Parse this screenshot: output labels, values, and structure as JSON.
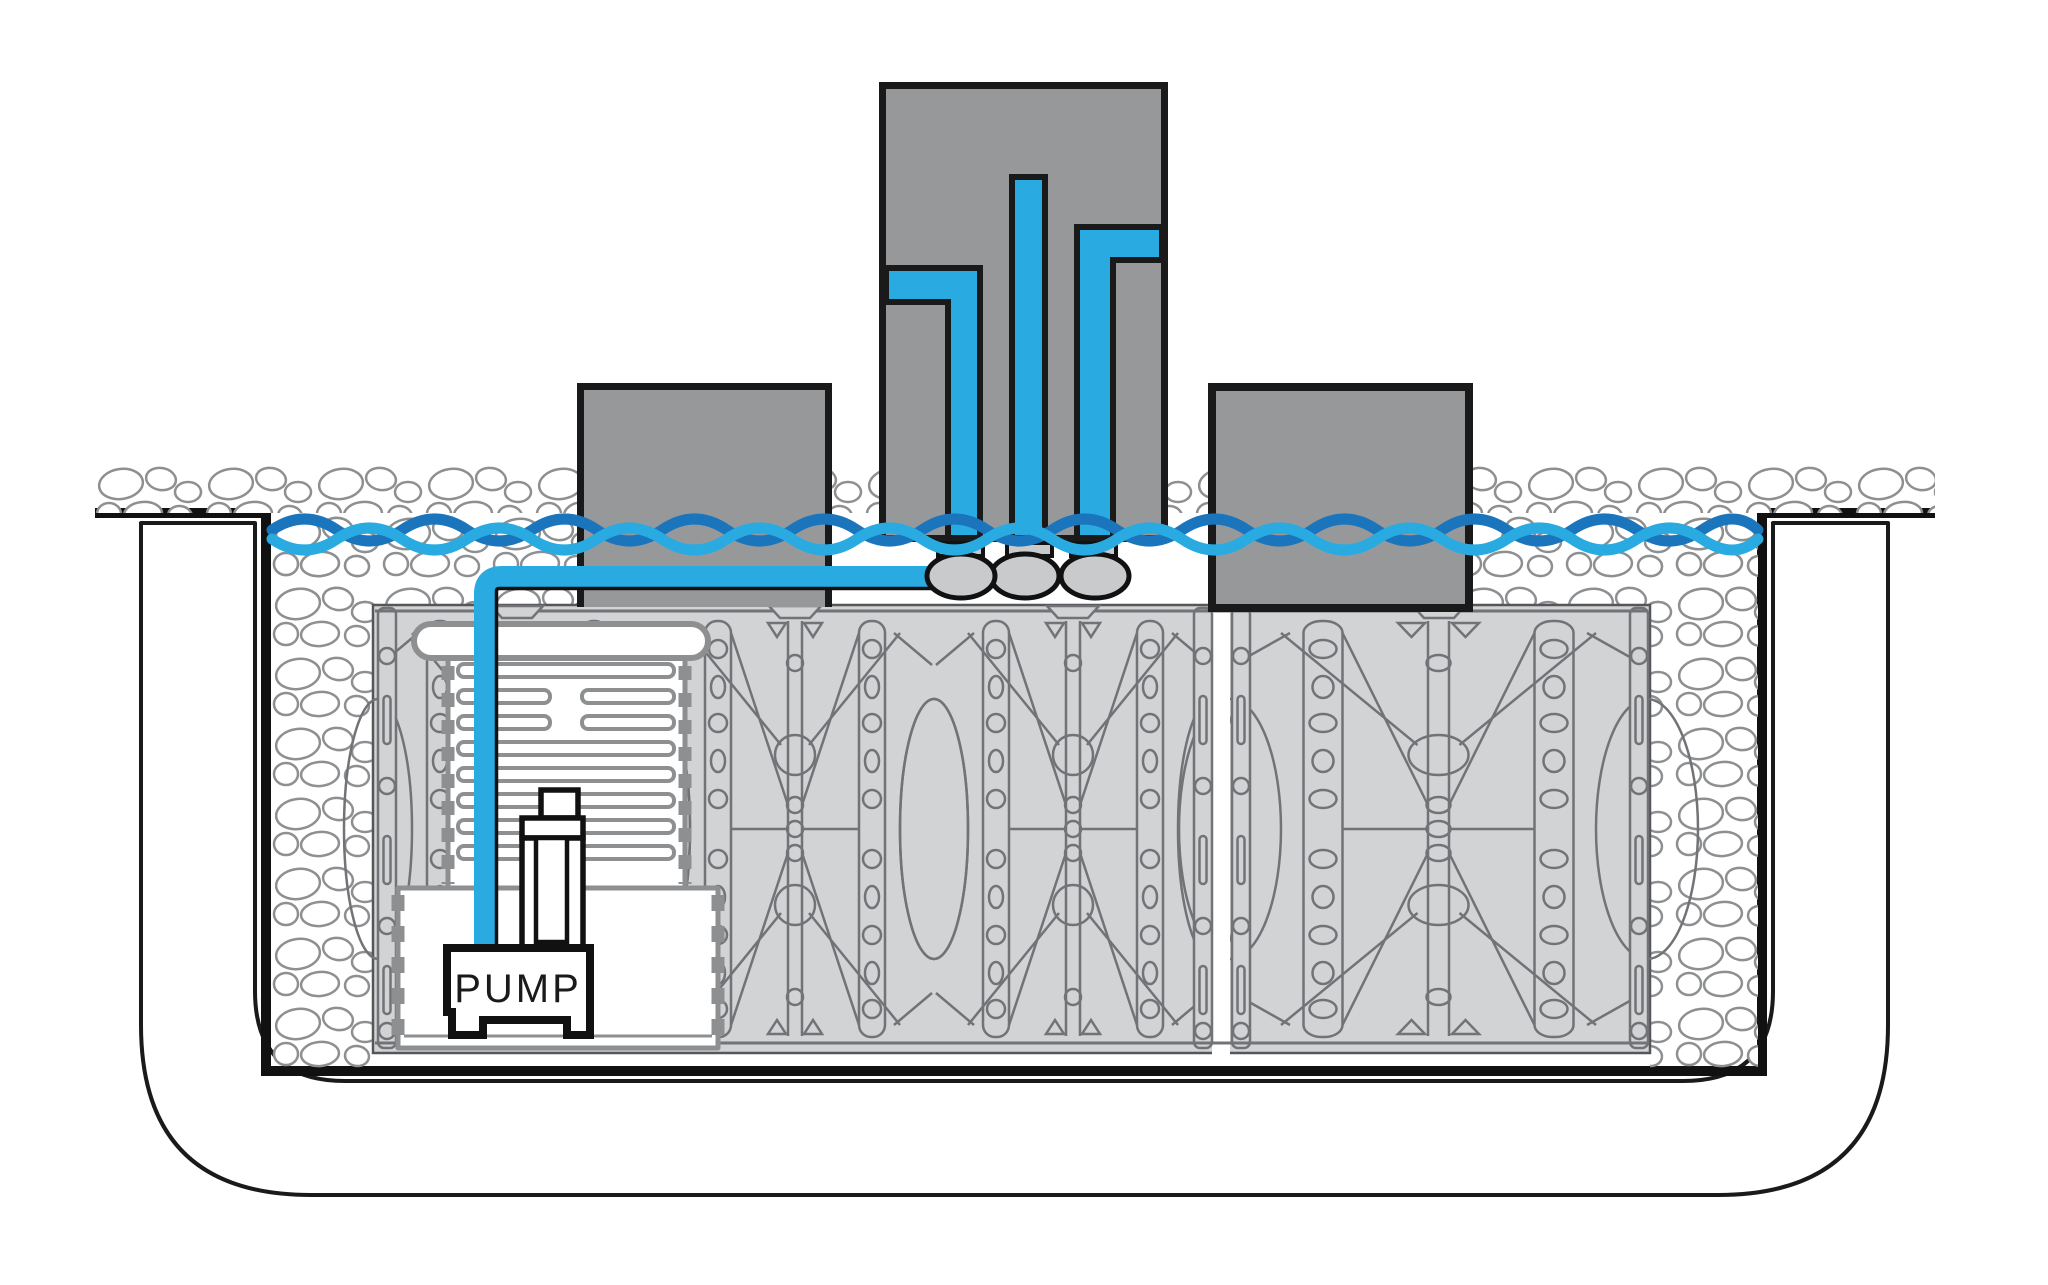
{
  "labels": {
    "pump": "PUMP"
  },
  "colors": {
    "background": "#FFFFFF",
    "outline_black": "#1A1A1A",
    "liner_black": "#111111",
    "pipe_water_blue": "#29ABE2",
    "water_line_dark_blue": "#1B75BC",
    "stone_block_gray": "#97989A",
    "crate_fill_gray": "#D2D3D5",
    "crate_line_gray": "#717376",
    "crate_edge_dark": "#55565A",
    "vault_outline_gray": "#8D8F91",
    "fitting_gray": "#C8CACC",
    "pebble_outline_gray": "#8D8F91",
    "pump_text_color": "#1A1A1A"
  },
  "components": [
    {
      "name": "excavated-basin",
      "description": "U-shaped basin wall cross-section with rounded bottom corners"
    },
    {
      "name": "liner",
      "description": "thick black liner wrapping gravel and crate field, overhanging both rims"
    },
    {
      "name": "surface-pebble-row",
      "description": "row of decorative pebbles along grade"
    },
    {
      "name": "gravel-backfill",
      "description": "pebble backfill columns along left and right sides"
    },
    {
      "name": "water-storage-crates",
      "description": "two banks of lattice water-matrix storage modules with a vertical seam"
    },
    {
      "name": "pump-vault",
      "description": "corrugated pump vault with lid, louver slats and lower chamber"
    },
    {
      "name": "pump",
      "description": "submersible pump box labeled PUMP"
    },
    {
      "name": "check-valve",
      "description": "vertical check valve fitting on pump discharge"
    },
    {
      "name": "supply-pipe",
      "description": "blue discharge pipe from pump, elbow, horizontal run to fountain manifold"
    },
    {
      "name": "fountain-stone-left",
      "description": "short gray stone column left of center"
    },
    {
      "name": "fountain-stone-center",
      "description": "tall gray stone with three internal fountain pipes"
    },
    {
      "name": "fountain-stone-right",
      "description": "short gray stone column right of center"
    },
    {
      "name": "pipe-fittings",
      "description": "three gray couplings and oval fittings under the center stone"
    },
    {
      "name": "water-level-line",
      "description": "two interwoven wavy water surface lines, light and dark blue"
    }
  ]
}
